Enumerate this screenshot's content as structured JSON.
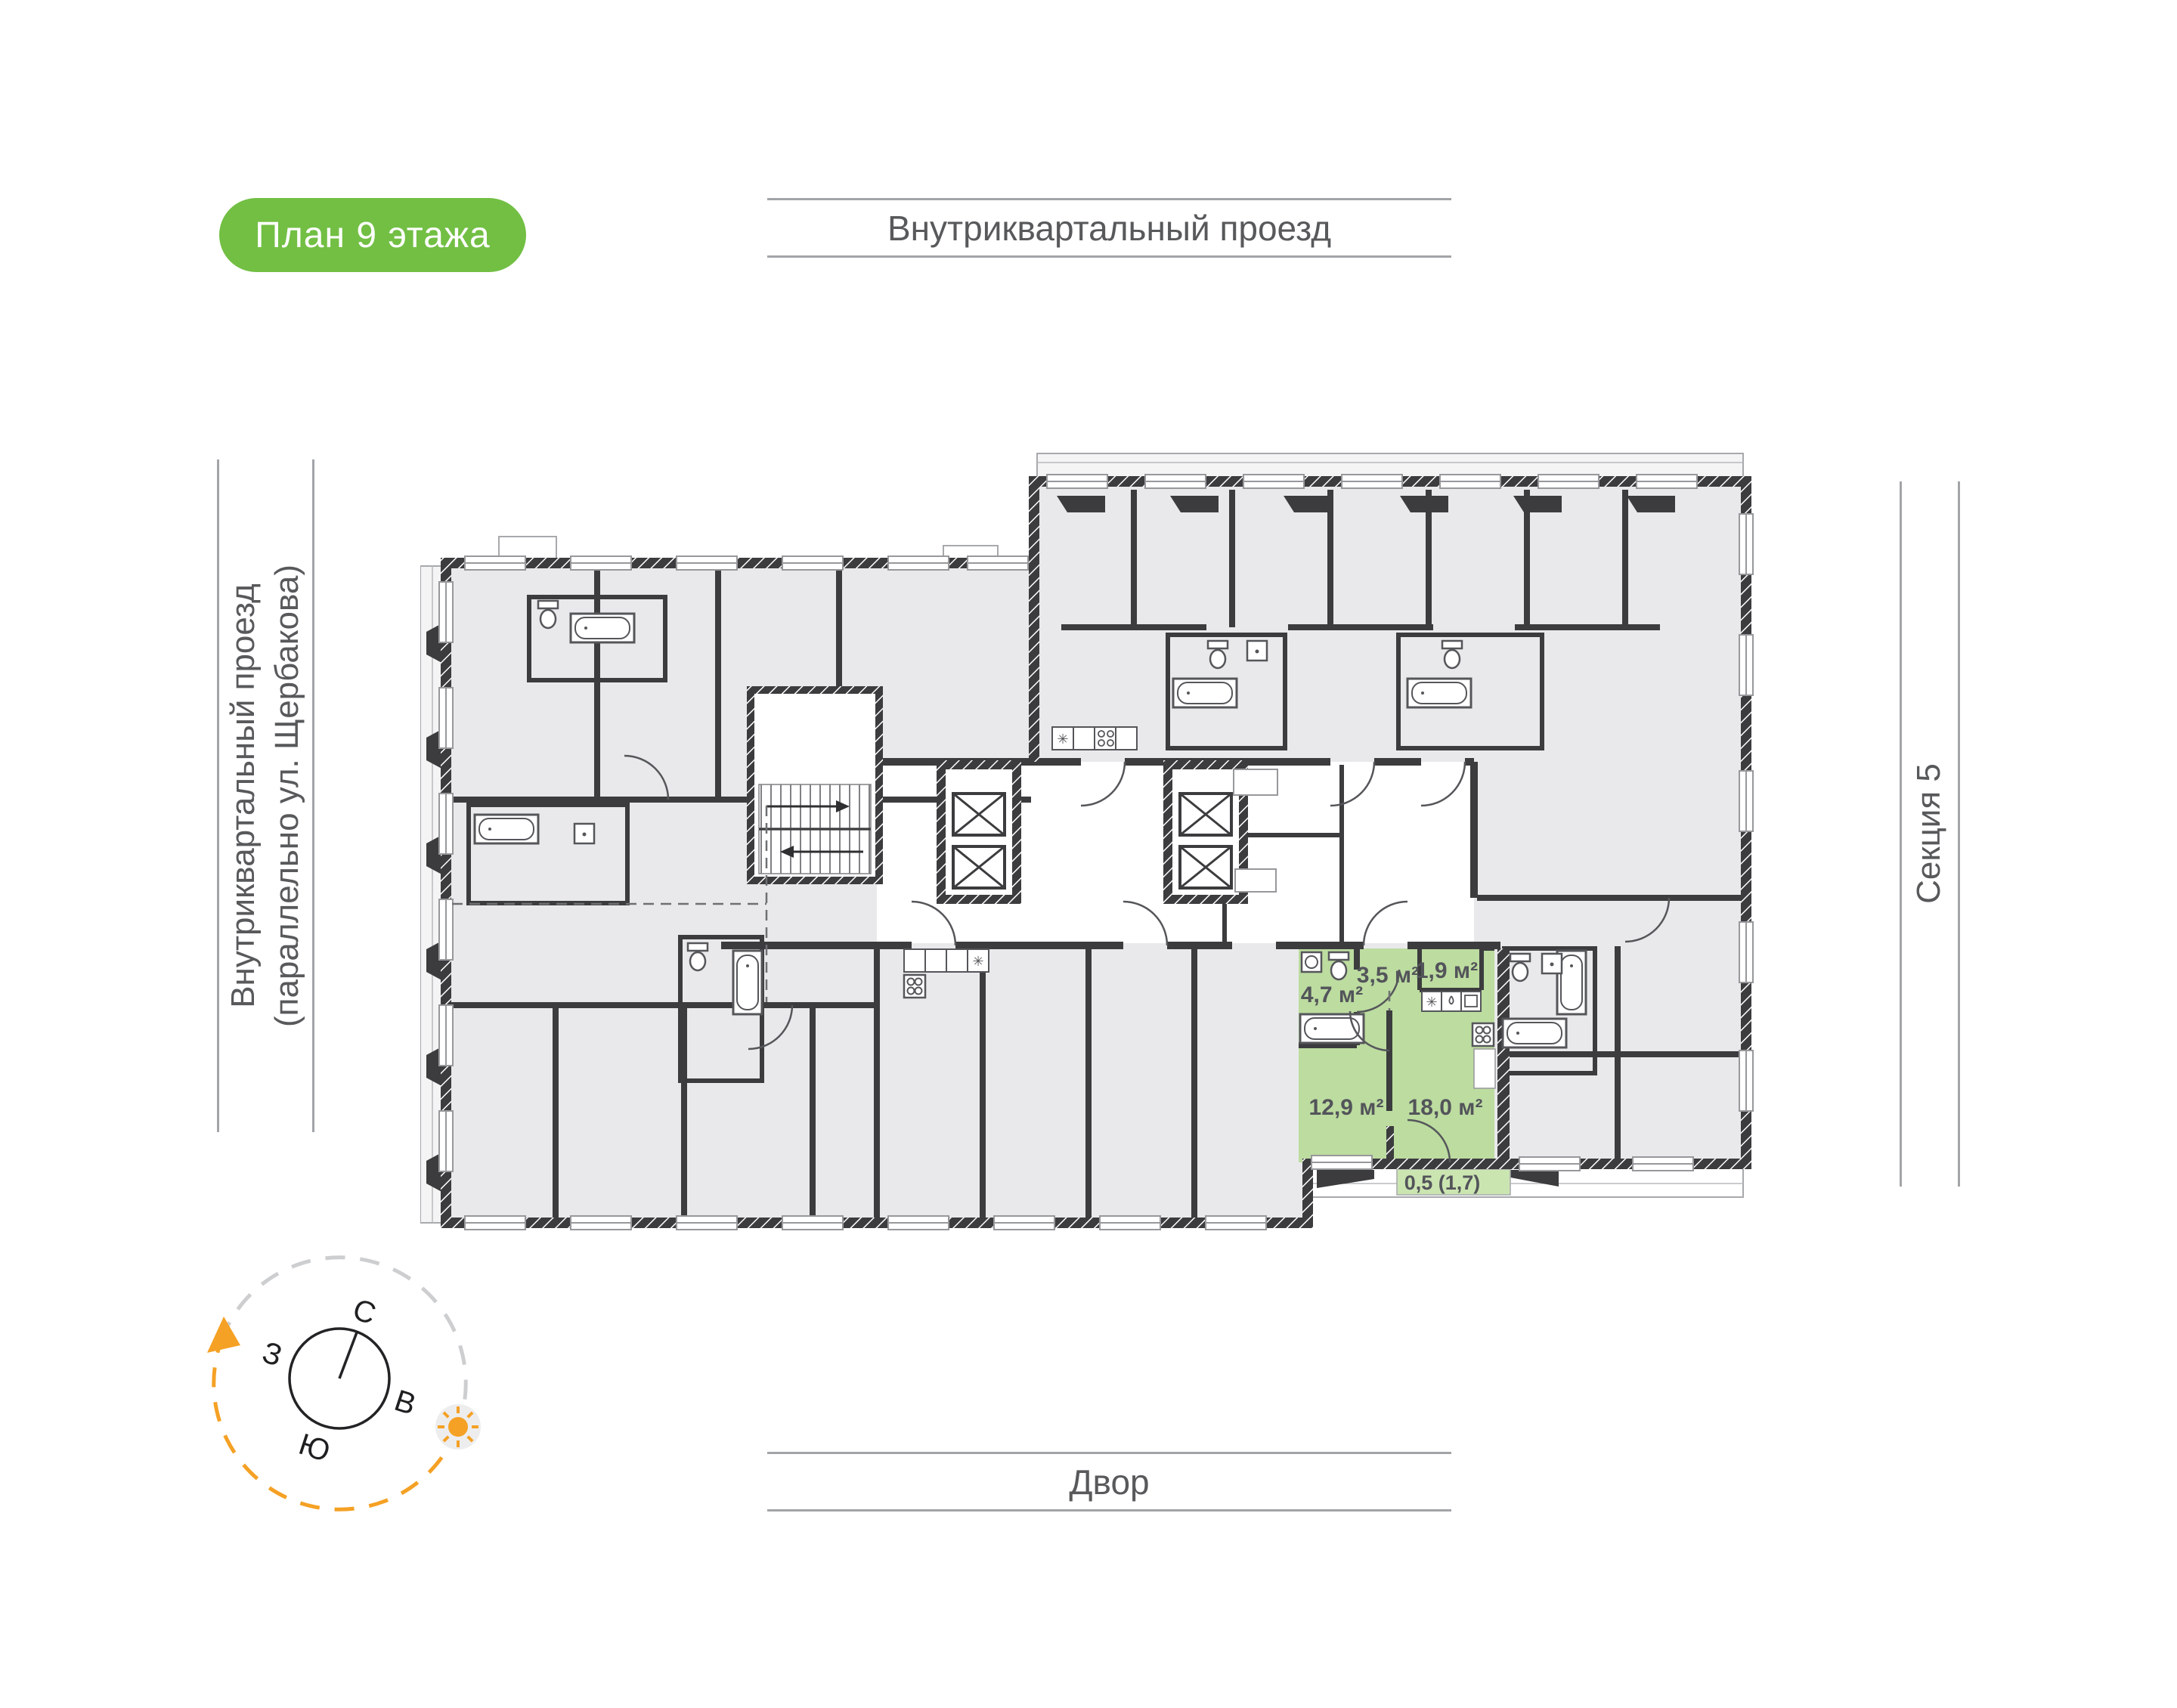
{
  "badge": {
    "label": "План 9 этажа"
  },
  "labels": {
    "top_street": "Внутриквартальный проезд",
    "left_street_line1": "Внутриквартальный проезд",
    "left_street_line2": "(параллельно ул. Щербакова)",
    "section": "Секция 5",
    "yard": "Двор"
  },
  "compass": {
    "north": "С",
    "east": "В",
    "south": "Ю",
    "west": "З"
  },
  "highlighted_apartment": {
    "rooms": [
      {
        "name": "bathroom",
        "area_label": "4,7 м²"
      },
      {
        "name": "hallway",
        "area_label": "3,5 м²"
      },
      {
        "name": "storage",
        "area_label": "1,9 м²"
      },
      {
        "name": "bedroom",
        "area_label": "12,9 м²"
      },
      {
        "name": "kitchen_living",
        "area_label": "18,0 м²"
      },
      {
        "name": "balcony",
        "area_label": "0,5 (1,7)"
      }
    ]
  },
  "colors": {
    "badge_green": "#72BF44",
    "apartment_green": "#BCDCA0",
    "balcony_green": "#CBE5B1",
    "wall_dark": "#3C3C3E",
    "room_gray": "#E9E9EB",
    "text_gray": "#58595B",
    "line_gray": "#A2A4A7",
    "compass_orange": "#F5A125"
  }
}
